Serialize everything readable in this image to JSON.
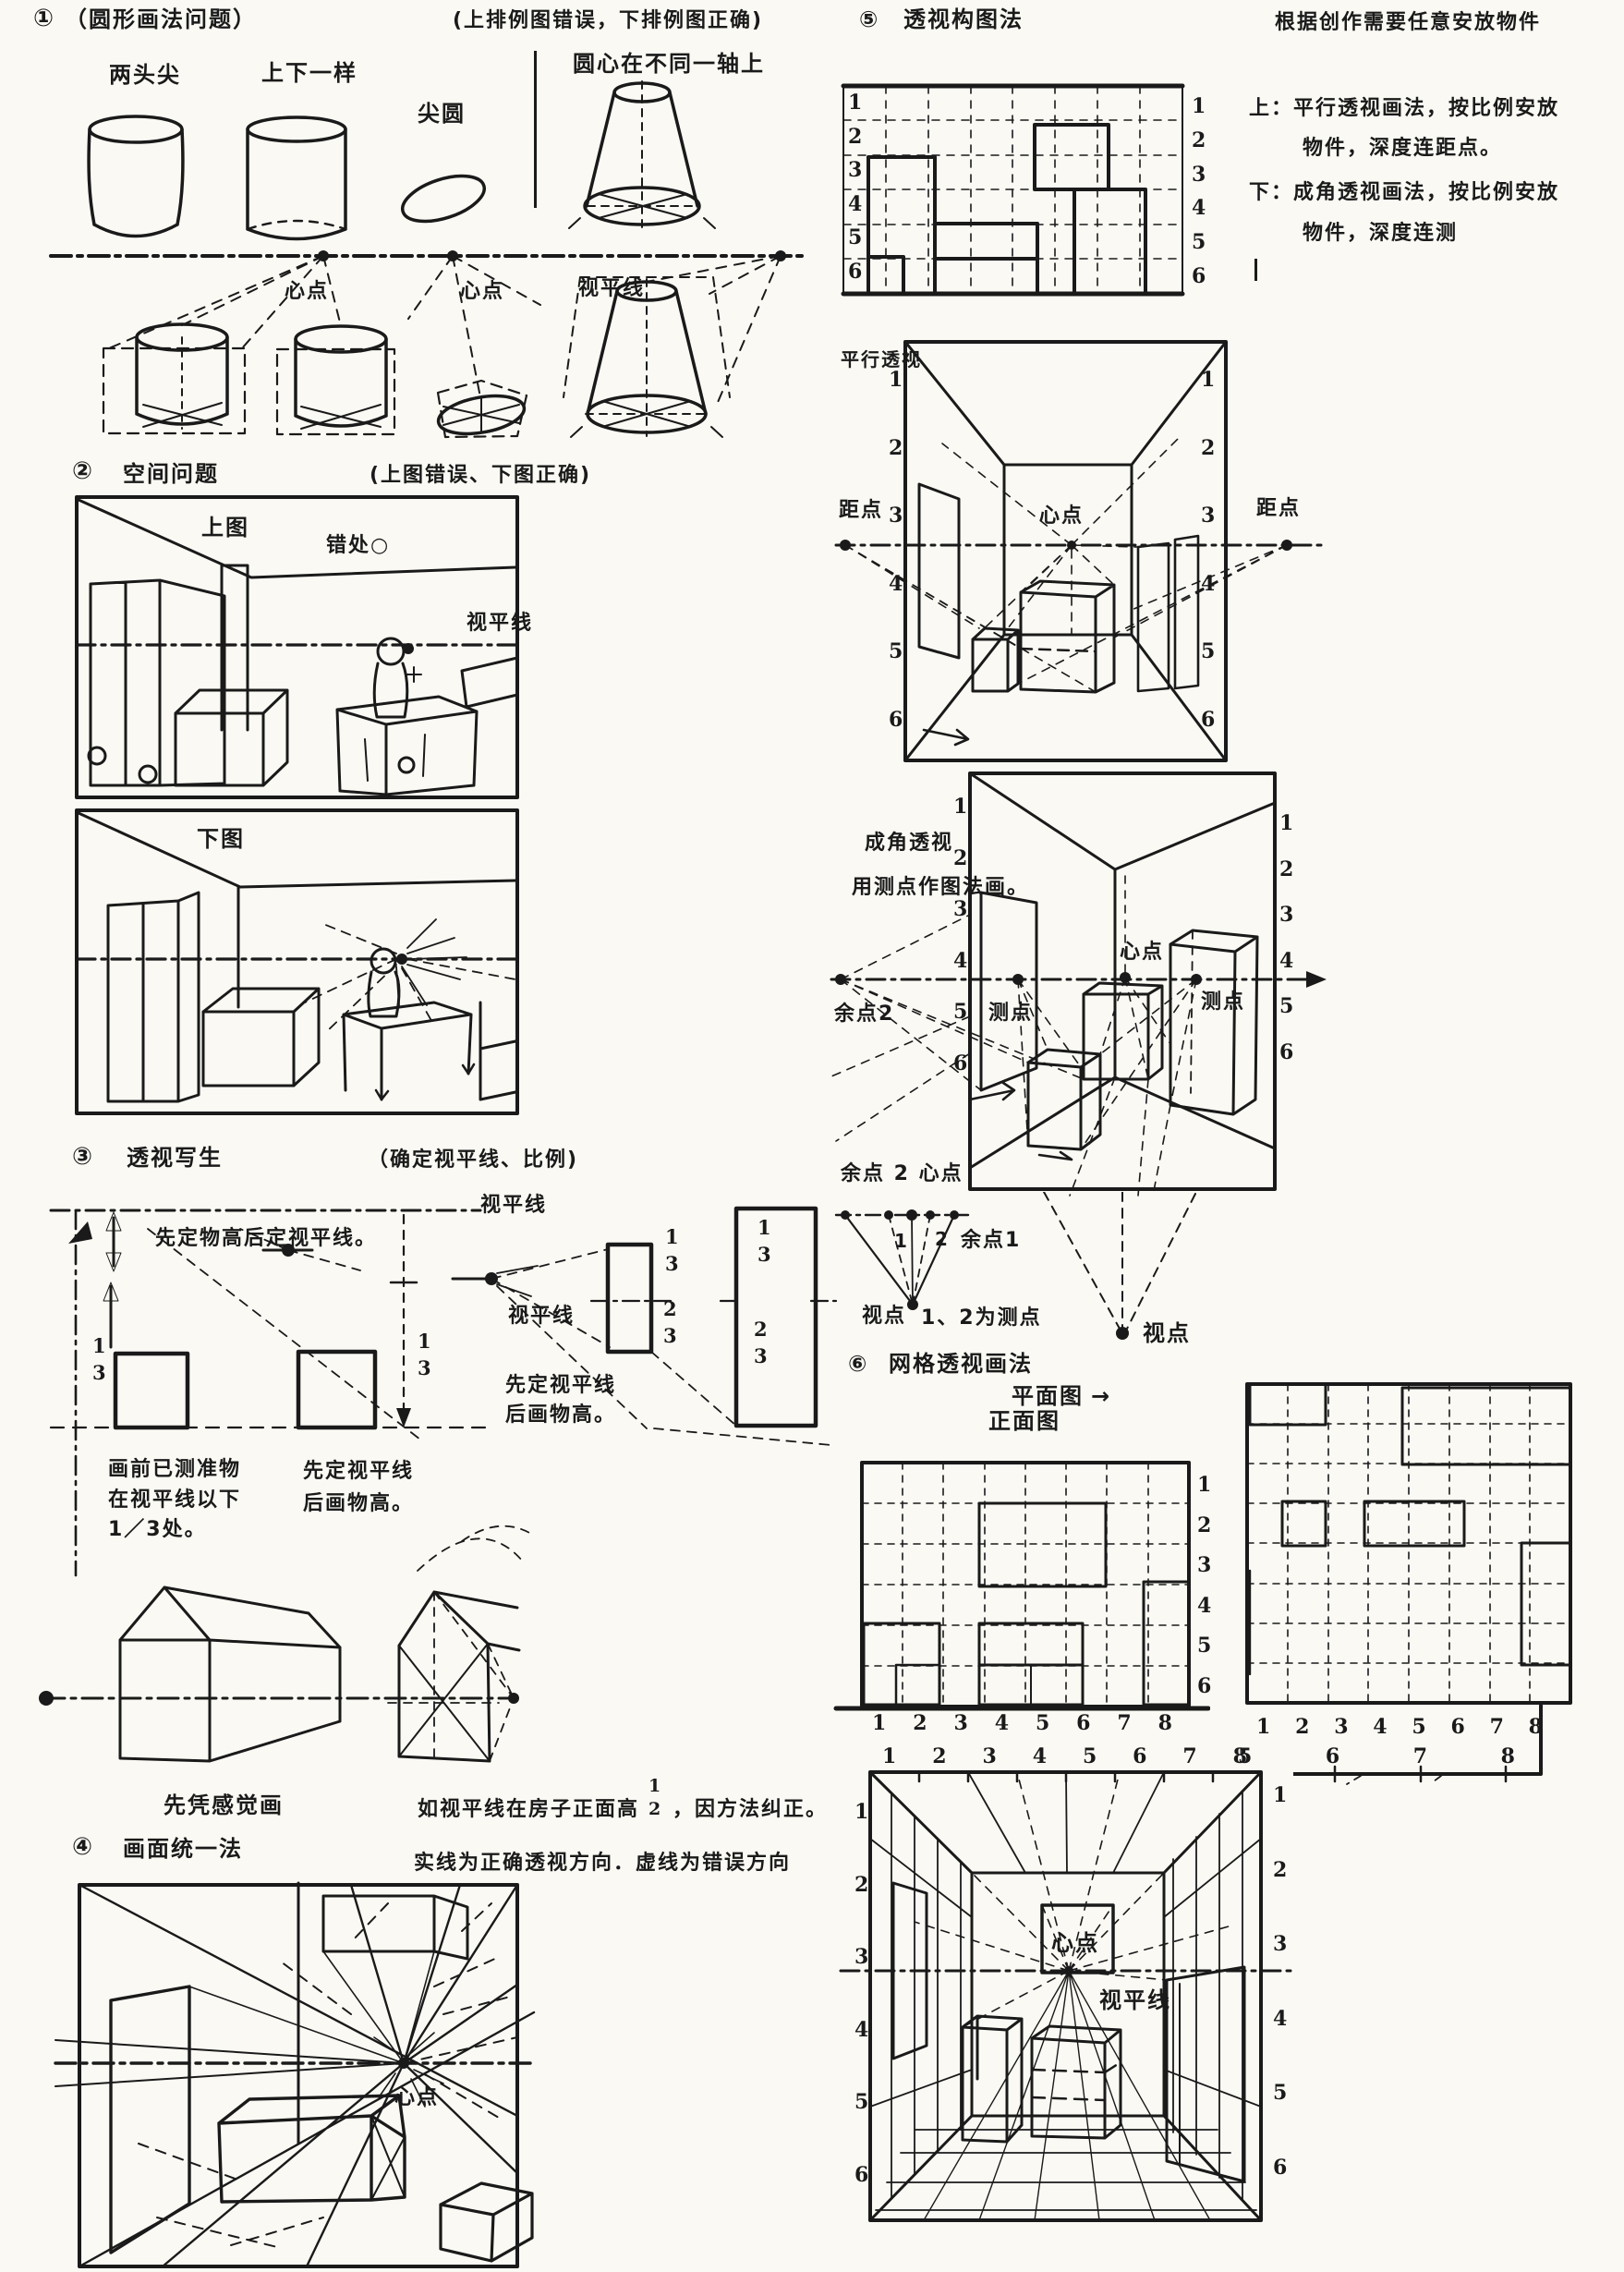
{
  "s1": {
    "num": "①",
    "title": "（圆形画法问题）",
    "note": "(上排例图错误，下排例图正确)",
    "labels": {
      "wrong_left": "两头尖",
      "wrong_right": "上下一样",
      "sharp_ellipse": "尖圆",
      "axis_note": "圆心在不同一轴上",
      "center_point_1": "心点",
      "center_point_2": "心点",
      "horizon": "视平线"
    }
  },
  "s2": {
    "num": "②",
    "title": "空间问题",
    "note": "(上图错误、下图正确)",
    "labels": {
      "top_picture": "上图",
      "error_spot": "错处○",
      "horizon": "视平线",
      "bottom_picture": "下图"
    }
  },
  "s3": {
    "num": "③",
    "title": "透视写生",
    "note": "（确定视平线、比例)",
    "labels": {
      "horizon_top": "视平线",
      "rule1": "先定物高后定视平线。",
      "horizon_mid": "视平线",
      "rule2_line1": "先定视平线",
      "rule2_line2": "后画物高。",
      "measured_line1": "画前已测准物",
      "measured_line2": "在视平线以下",
      "measured_line3": "1／3处。",
      "rule3_line1": "先定视平线",
      "rule3_line2": "后画物高。",
      "feel_first": "先凭感觉画",
      "correct_pre": "如视平线在房子正面高",
      "correct_post": "，因方法纠正。"
    },
    "fractions": {
      "left": [
        "1",
        "3"
      ],
      "arrow_right": [
        "1",
        "3"
      ],
      "small_rect_upper": [
        "1",
        "3"
      ],
      "small_rect_lower": [
        "2",
        "3"
      ],
      "big_rect_upper": [
        "1",
        "3"
      ],
      "big_rect_lower": [
        "2",
        "3"
      ],
      "half": [
        "1",
        "2"
      ]
    }
  },
  "s4": {
    "num": "④",
    "title": "画面统一法",
    "note": "实线为正确透视方向．虚线为错误方向",
    "labels": {
      "center_point": "心点"
    }
  },
  "s5": {
    "num": "⑤",
    "title": "透视构图法",
    "header_right": "根据创作需要任意安放物件",
    "item_top_prefix": "上：",
    "item_top_line1": "平行透视画法，按比例安放",
    "item_top_line2": "物件，深度连距点。",
    "item_bottom_prefix": "下：",
    "item_bottom_line1": "成角透视画法，按比例安放",
    "item_bottom_line2": "物件，深度连测",
    "nums_left": [
      "1",
      "2",
      "3",
      "4",
      "5",
      "6"
    ],
    "nums_right": [
      "1",
      "2",
      "3",
      "4",
      "5",
      "6"
    ]
  },
  "room1": {
    "label": "平行透视",
    "distance_left": "距点",
    "distance_right": "距点",
    "center_point": "心点",
    "nums_left": [
      "1",
      "2",
      "3",
      "4",
      "5",
      "6"
    ],
    "nums_right": [
      "1",
      "2",
      "3",
      "4",
      "5",
      "6"
    ]
  },
  "room2": {
    "label_line1": "成角透视",
    "label_line2": "用测点作图法画。",
    "vp2": "余点2",
    "center_point": "心点",
    "measure_left": "测点",
    "measure_right": "测点",
    "bottom_label": "余点 2 心点",
    "nums_left": [
      "1",
      "2",
      "3",
      "4",
      "5",
      "6"
    ],
    "nums_right": [
      "1",
      "2",
      "3",
      "4",
      "5",
      "6"
    ]
  },
  "fan": {
    "n1": "1",
    "n2": "2",
    "vp1": "余点1",
    "viewpoint": "视点",
    "note": "1、2为测点",
    "viewpoint_right": "视点"
  },
  "s6": {
    "num": "⑥",
    "title": "网格透视画法",
    "plan_label": "平面图",
    "plan_arrow": "→",
    "front_label": "正面图",
    "front_nums_bottom": [
      "1",
      "2",
      "3",
      "4",
      "5",
      "6",
      "7",
      "8"
    ],
    "front_nums_right": [
      "1",
      "2",
      "3",
      "4",
      "5",
      "6"
    ],
    "plan_nums_bottom": [
      "1",
      "2",
      "3",
      "4",
      "5",
      "6",
      "7",
      "8"
    ]
  },
  "room3": {
    "nums_top": [
      "1",
      "2",
      "3",
      "4",
      "5",
      "6",
      "7",
      "8"
    ],
    "nums_ext": [
      "5",
      "6",
      "7",
      "8"
    ],
    "nums_left": [
      "1",
      "2",
      "3",
      "4",
      "5",
      "6"
    ],
    "nums_right": [
      "1",
      "2",
      "3",
      "4",
      "5",
      "6"
    ],
    "center_point": "心点",
    "horizon": "视平线"
  }
}
